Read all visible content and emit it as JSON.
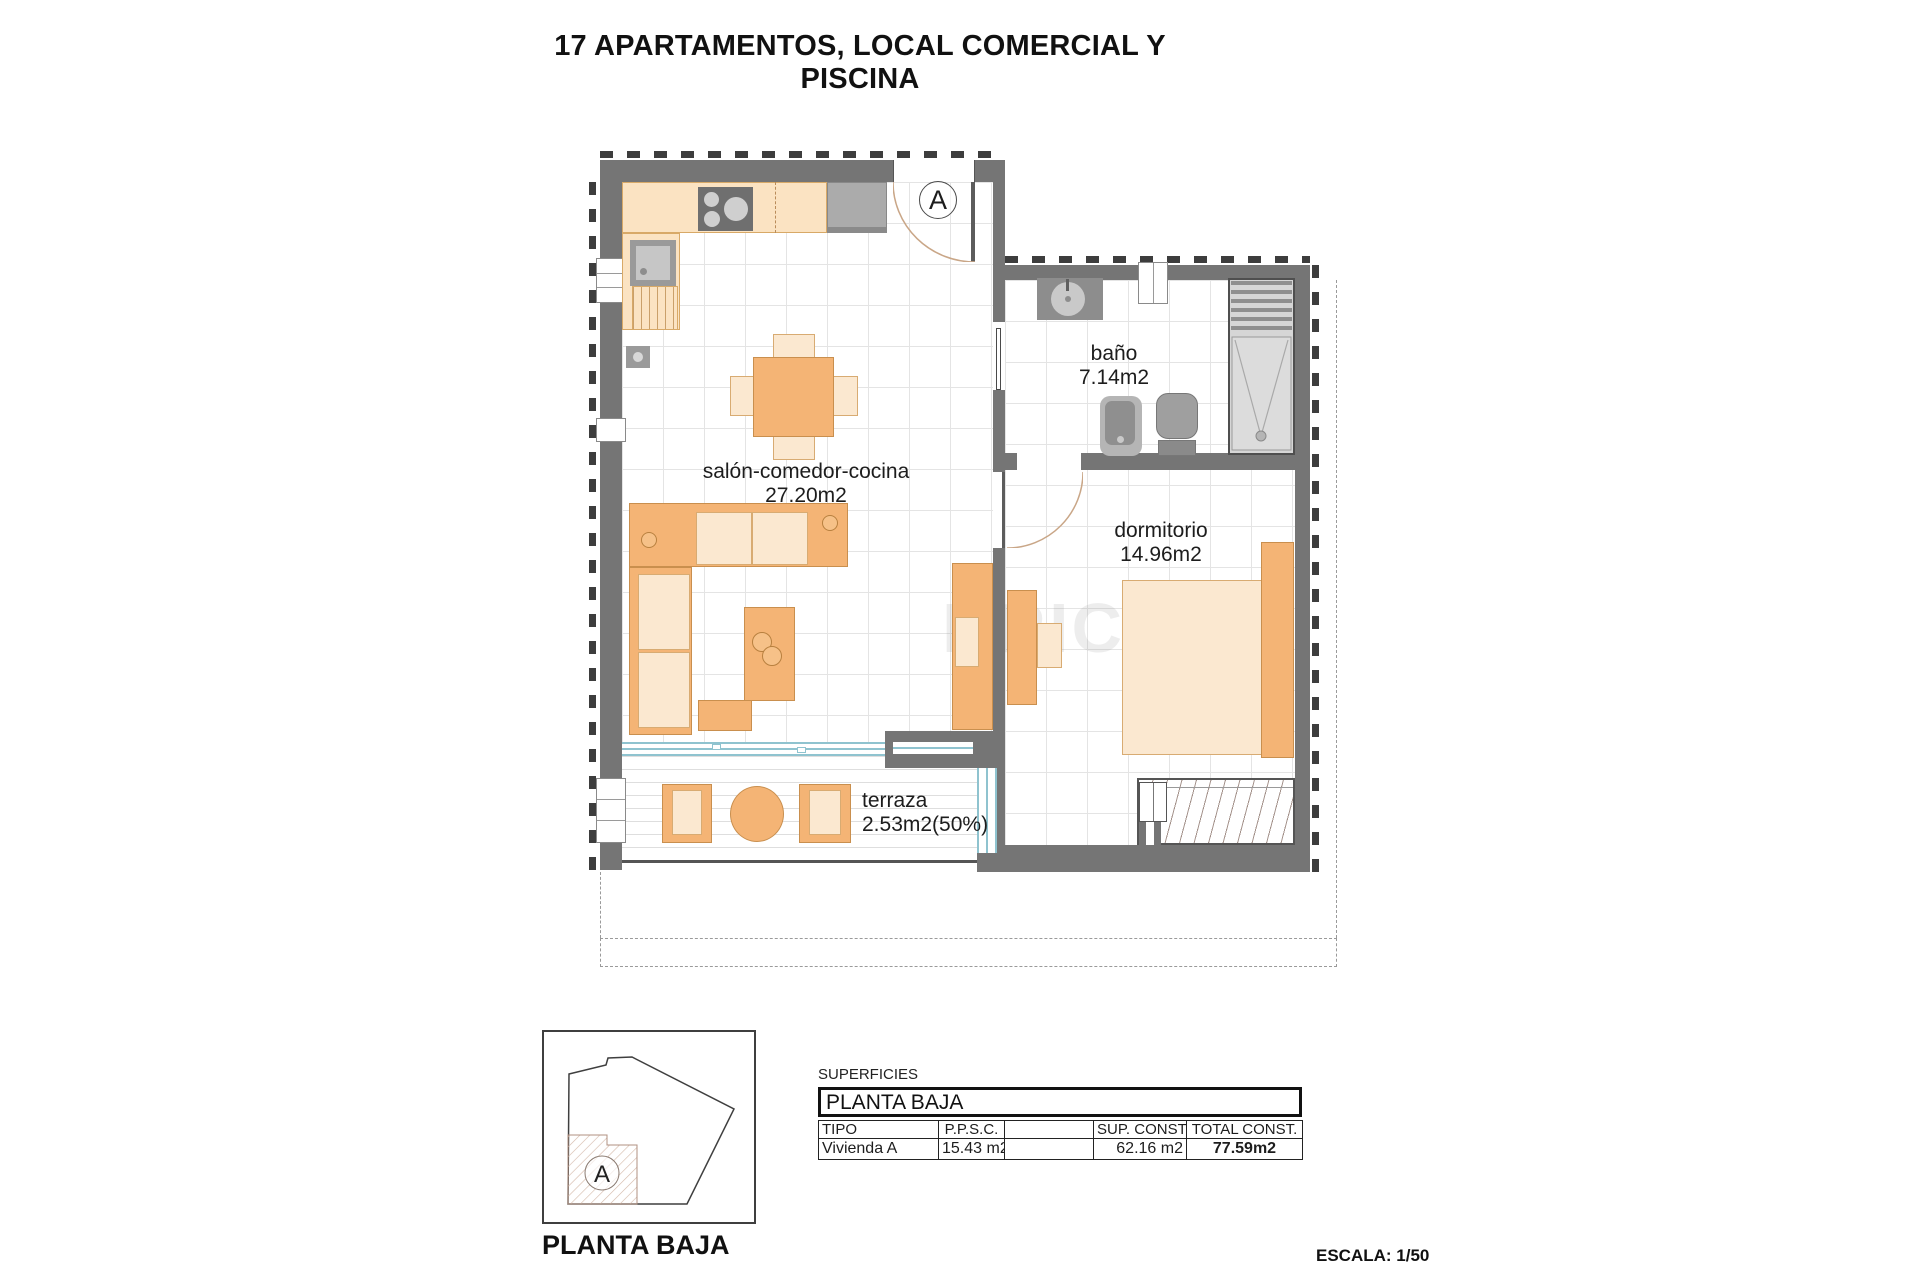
{
  "title": "17 APARTAMENTOS, LOCAL COMERCIAL Y PISCINA",
  "plan": {
    "unit_label": "A",
    "rooms": {
      "salon": {
        "name": "salón-comedor-cocina",
        "area": "27.20m2"
      },
      "bano": {
        "name": "baño",
        "area": "7.14m2"
      },
      "dormitorio": {
        "name": "dormitorio",
        "area": "14.96m2"
      },
      "terraza": {
        "name": "terraza",
        "area": "2.53m2(50%)"
      }
    }
  },
  "watermark": "BRIC",
  "key_plan": {
    "unit_label": "A",
    "caption": "PLANTA BAJA"
  },
  "surfaces": {
    "section_label": "SUPERFICIES",
    "floor_header": "PLANTA BAJA",
    "columns": {
      "tipo": "TIPO",
      "ppsc": "P.P.S.C.",
      "blank": "",
      "sup_const": "SUP. CONST.",
      "total_const": "TOTAL CONST."
    },
    "row": {
      "tipo": "Vivienda A",
      "ppsc": "15.43 m2",
      "blank": "",
      "sup_const": "62.16 m2",
      "total_const": "77.59m2"
    }
  },
  "scale_note": "ESCALA: 1/50",
  "colors": {
    "wall": "#757575",
    "hatch": "#3d3d3d",
    "furniture_orange": "#f4b475",
    "furniture_light": "#fbe8d0",
    "counter": "#fbe3c2",
    "fixture_gray": "#9a9a9a",
    "window_blue": "#8fc3cf",
    "grid": "#e4e4e4"
  }
}
